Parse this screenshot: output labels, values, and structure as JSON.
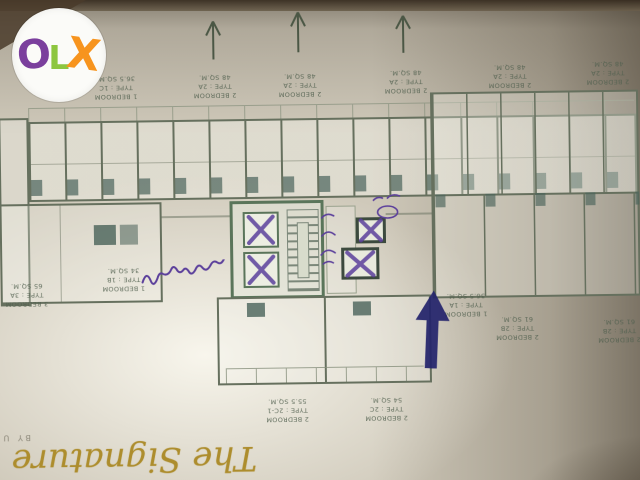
{
  "watermark": {
    "name": "OLX",
    "background": "#fbfbf8",
    "letters": [
      {
        "char": "O",
        "color": "#7b3f9d"
      },
      {
        "char": "L",
        "color": "#8dc63f"
      },
      {
        "char": "X",
        "color": "#f7941e"
      }
    ]
  },
  "plan": {
    "unit_labels": [
      {
        "id": "1c",
        "text": "1 BEDROOM\nTYPE : 1C\n36.5 SQ.M."
      },
      {
        "id": "2a1",
        "text": "2 BEDROOM\nTYPE : 2A\n48 SQ.M."
      },
      {
        "id": "2a2",
        "text": "2 BEDROOM\nTYPE : 2A\n48 SQ.M."
      },
      {
        "id": "2a3",
        "text": "2 BEDROOM\nTYPE : 2A\n48 SQ.M."
      },
      {
        "id": "2a4",
        "text": "2 BEDROOM\nTYPE : 2A\n48 SQ.M."
      },
      {
        "id": "2a5",
        "text": "2 BEDROOM\nTYPE : 2A\n48 SQ.M."
      },
      {
        "id": "3a",
        "text": "3 BEDROOM\nTYPE : 3A\n65 SQ.M."
      },
      {
        "id": "1b",
        "text": "1 BEDROOM\nTYPE : 1B\n34 SQ.M."
      },
      {
        "id": "1a",
        "text": "1 BEDROOM\nTYPE : 1A\n36.5 SQ.M."
      },
      {
        "id": "2b1",
        "text": "2 BEDROOM\nTYPE : 2B\n61 SQ.M."
      },
      {
        "id": "2b2",
        "text": "2 BEDROOM\nTYPE : 2B\n61 SQ.M."
      },
      {
        "id": "2c1",
        "text": "2 BEDROOM\nTYPE : 2C-1\n55.5 SQ.M."
      },
      {
        "id": "2c",
        "text": "2 BEDROOM\nTYPE : 2C\n54 SQ.M."
      }
    ],
    "annotations": {
      "handwritten_note": "อยู่ตรงนี้",
      "lift_note_vertical": "ลิฟ",
      "lift_note_circled": "ลิฟ"
    },
    "branding": {
      "script": "The Signature",
      "subscript": "by URBANO"
    },
    "colors": {
      "paper": "#d6d2c4",
      "linework": "#66705e",
      "teal_fixture": "#4a635a",
      "purple_ink": "#5b3f9b",
      "blue_ink": "#23236b",
      "brand_gold": "#ad8d2d"
    }
  }
}
